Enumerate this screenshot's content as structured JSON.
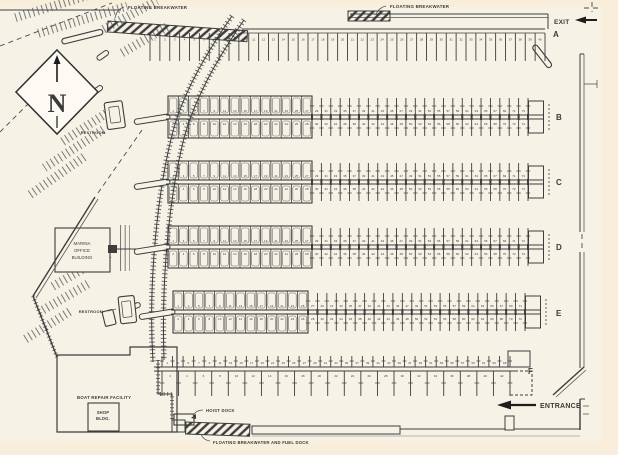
{
  "map": {
    "colors": {
      "background": "#f8eedb",
      "paper": "#f6f2e6",
      "ink": "#3d3d3d",
      "ink_light": "#6a6a6a"
    },
    "compass": {
      "letter": "N"
    },
    "labels": {
      "breakwater_top_left": "FLOATING BREAKWATER",
      "breakwater_top_right": "FLOATING BREAKWATER",
      "breakwater_bottom": "FLOATING BREAKWATER AND FUEL DOCK",
      "exit": "EXIT",
      "entrance": "ENTRANCE",
      "hoist_dock": "HOIST DOCK",
      "restroom_upper": "RESTROOM",
      "restroom_lower": "RESTROOM",
      "boat_repair_facility": "BOAT REPAIR FACILITY",
      "shop_line1": "SHOP",
      "shop_line2": "BLDG.",
      "office_line1": "MARINA",
      "office_line2": "OFFICE",
      "office_line3": "BUILDING"
    },
    "arrows": {
      "exit_direction": "left",
      "entrance_direction": "left"
    },
    "docks": [
      {
        "label": "A",
        "type": "single",
        "y": 31,
        "x_start": 150,
        "x_end": 545,
        "slips": 40,
        "label_x": 553,
        "label_y": 37
      },
      {
        "label": "B",
        "type": "double",
        "y": 117,
        "x_start": 168,
        "x_end": 528,
        "covered_until": 312,
        "covered_bays": 14,
        "open_slips": 23,
        "label_x": 556,
        "label_y": 120
      },
      {
        "label": "C",
        "type": "double",
        "y": 182,
        "x_start": 168,
        "x_end": 528,
        "covered_until": 312,
        "covered_bays": 14,
        "open_slips": 23,
        "label_x": 556,
        "label_y": 185
      },
      {
        "label": "D",
        "type": "double",
        "y": 247,
        "x_start": 168,
        "x_end": 528,
        "covered_until": 312,
        "covered_bays": 14,
        "open_slips": 23,
        "label_x": 556,
        "label_y": 250
      },
      {
        "label": "E",
        "type": "double",
        "y": 312,
        "x_start": 173,
        "x_end": 525,
        "covered_until": 308,
        "covered_bays": 13,
        "open_slips": 23,
        "label_x": 556,
        "label_y": 316
      },
      {
        "label": "F",
        "type": "asym",
        "y": 369,
        "x_start": 162,
        "x_end": 510,
        "slips": 33,
        "label_x": 528,
        "label_y": 374
      }
    ]
  }
}
